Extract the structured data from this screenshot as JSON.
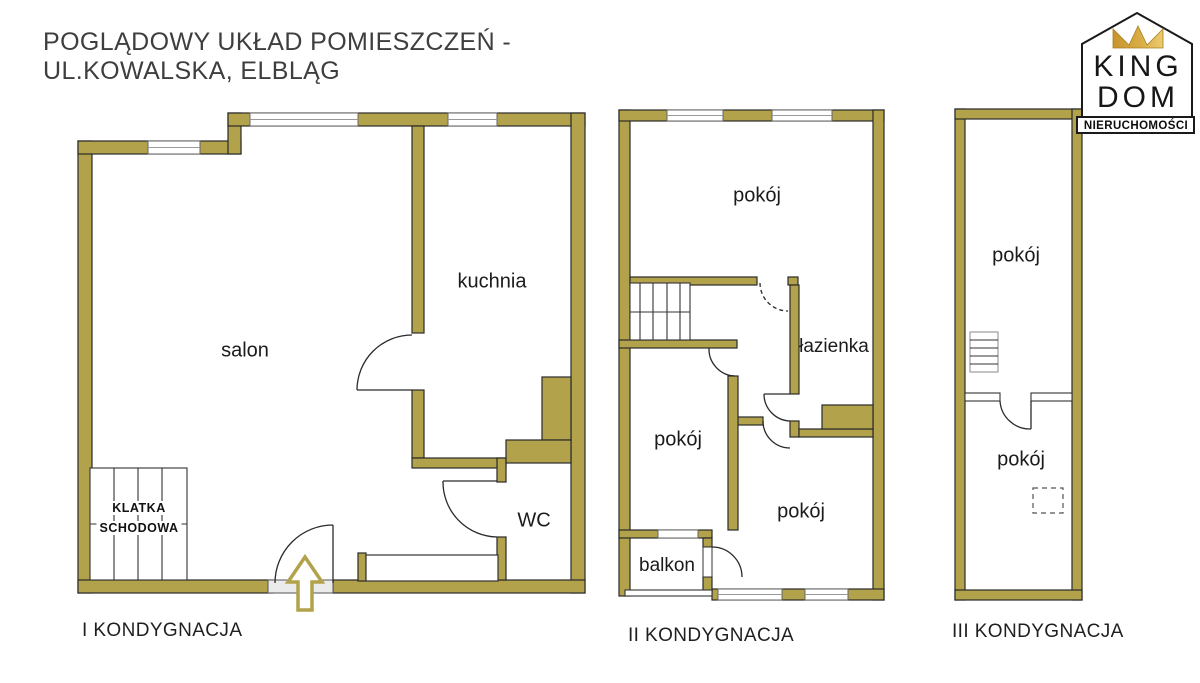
{
  "title": {
    "line1": "POGLĄDOWY UKŁAD POMIESZCZEŃ -",
    "line2": "UL.KOWALSKA, ELBLĄG"
  },
  "logo": {
    "name_top": "KING",
    "name_bottom": "DOM",
    "tagline": "NIERUCHOMOŚCI"
  },
  "floor1": {
    "label": "I KONDYGNACJA",
    "salon": "salon",
    "kuchnia": "kuchnia",
    "wc": "WC",
    "stairs_line1": "KLATKA",
    "stairs_line2": "SCHODOWA"
  },
  "floor2": {
    "label": "II KONDYGNACJA",
    "room_top": "pokój",
    "bathroom": "łazienka",
    "room_left": "pokój",
    "room_right": "pokój",
    "balcony": "balkon"
  },
  "floor3": {
    "label": "III KONDYGNACJA",
    "room_top": "pokój",
    "room_bottom": "pokój"
  },
  "colors": {
    "wall": "#b2a24c",
    "outline": "#2a2a2a",
    "window_frame": "#666666",
    "sill": "#ebebeb",
    "crown_dark": "#c8942e",
    "crown_light": "#eccb6f",
    "text": "#1b1b1b"
  }
}
